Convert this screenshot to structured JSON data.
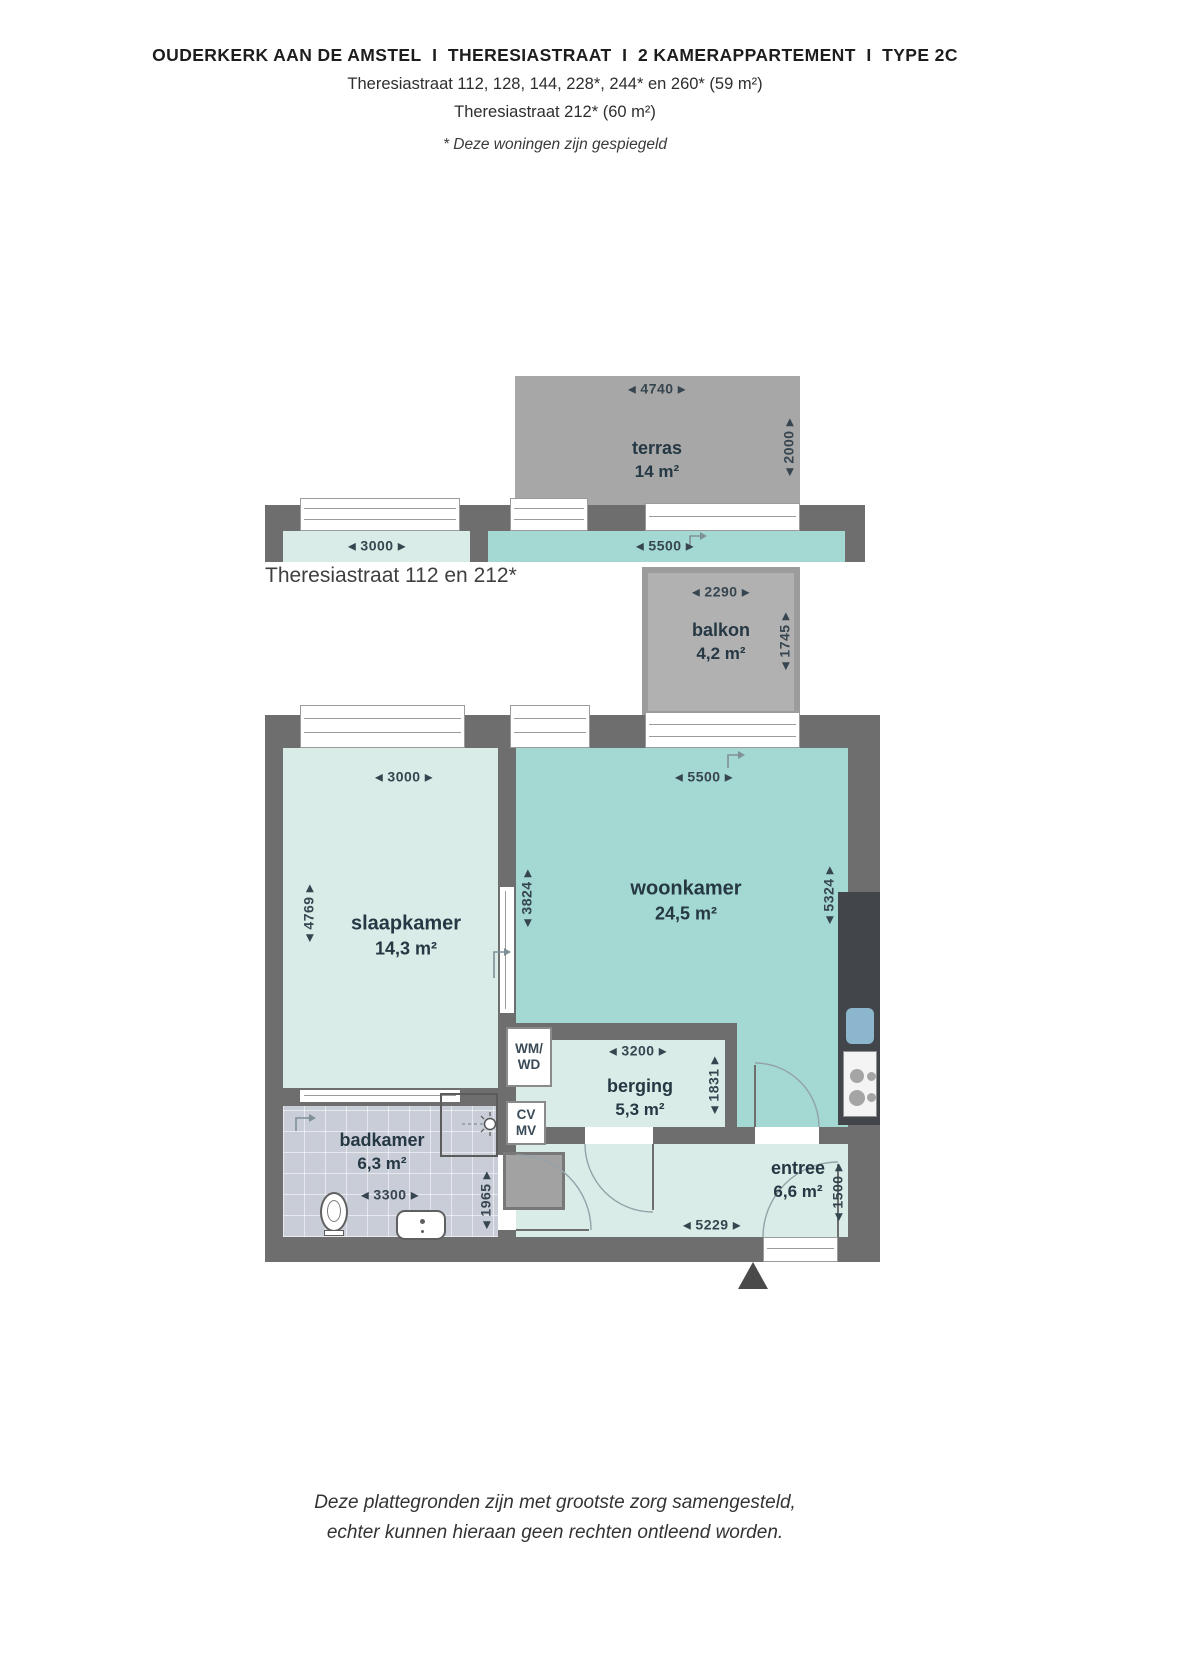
{
  "header": {
    "title": "OUDERKERK AAN DE AMSTEL  I  THERESIASTRAAT  I  2 KAMERAPPARTEMENT  I  TYPE 2C",
    "line2": "Theresiastraat 112, 128, 144, 228*, 244* en 260* (59 m²)",
    "line3": "Theresiastraat 212* (60 m²)",
    "note": "* Deze woningen zijn gespiegeld"
  },
  "section_label": "Theresiastraat 112 en 212*",
  "outdoor": {
    "terras": {
      "name": "terras",
      "area": "14 m²",
      "dim_top": "◂ 4740 ▸",
      "dim_right": "◂ 2000 ▸"
    },
    "balkon": {
      "name": "balkon",
      "area": "4,2 m²",
      "dim_top": "◂ 2290 ▸",
      "dim_right": "◂ 1745 ▸"
    },
    "strip": {
      "dim_left": "◂ 3000 ▸",
      "dim_right": "◂ 5500 ▸"
    }
  },
  "rooms": {
    "slaapkamer": {
      "name": "slaapkamer",
      "area": "14,3 m²",
      "dim_top": "◂ 3000 ▸",
      "dim_left": "◂ 4769 ▸",
      "dim_right": "◂ 3824 ▸"
    },
    "woonkamer": {
      "name": "woonkamer",
      "area": "24,5 m²",
      "dim_top": "◂ 5500 ▸",
      "dim_right": "◂ 5324 ▸"
    },
    "berging": {
      "name": "berging",
      "area": "5,3 m²",
      "dim_top": "◂ 3200 ▸",
      "dim_right": "◂ 1831 ▸"
    },
    "badkamer": {
      "name": "badkamer",
      "area": "6,3 m²",
      "dim_bottom": "◂ 3300 ▸",
      "dim_right": "◂ 1965 ▸"
    },
    "entree": {
      "name": "entree",
      "area": "6,6 m²",
      "dim_bottom": "◂ 5229 ▸",
      "dim_right": "◂ 1500 ▸"
    }
  },
  "fixtures": {
    "wm_wd": {
      "line1": "WM/",
      "line2": "WD"
    },
    "cv_mv": {
      "line1": "CV",
      "line2": "MV"
    }
  },
  "footer": {
    "line1": "Deze plattegronden zijn met grootste zorg samengesteld,",
    "line2": "echter kunnen hieraan geen rechten ontleend worden."
  },
  "colors": {
    "wall": "#6e6e6e",
    "mint": "#d9ece8",
    "teal": "#a4d8d2",
    "tile": "#c9cdd8",
    "terrace": "#a7a7a7",
    "balcony": "#b1b1b1",
    "counter": "#42464a",
    "sink": "#8cb6ce",
    "dim_text": "#36454f",
    "label_text": "#253843"
  }
}
